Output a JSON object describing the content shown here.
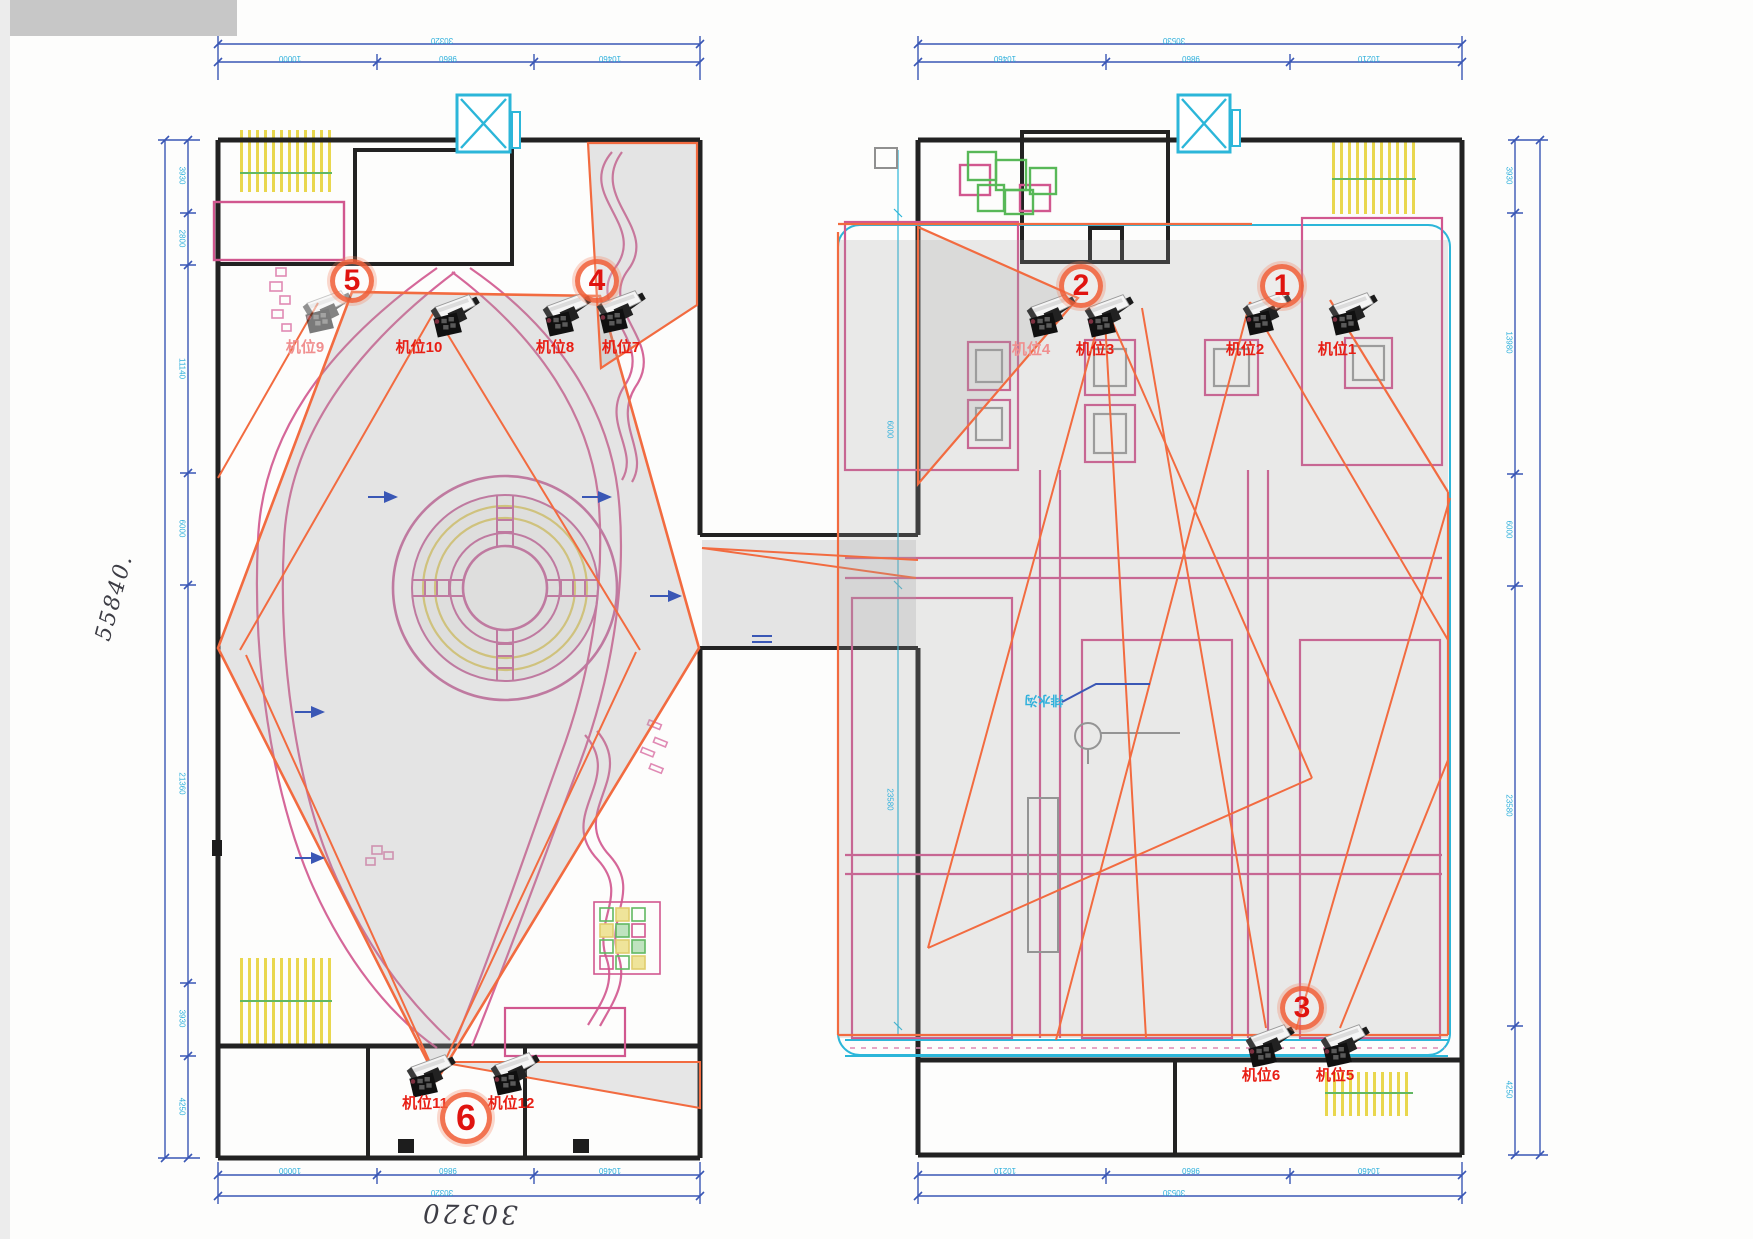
{
  "drawing": {
    "type": "cctv-camera-placement-floor-plan",
    "buildings": [
      "left-garden-block",
      "right-warehouse-block"
    ]
  },
  "colors": {
    "wall": "#1f1f1f",
    "pink": "#d1578f",
    "magenta": "#c44a8c",
    "yellow": "#e6d45a",
    "green": "#62b862",
    "teal": "#2cb6d9",
    "dim_blue": "#3a57b5",
    "dim_cyan": "#2fb0dc",
    "coverage_orange": "#f26b40",
    "marker_red": "#e01410",
    "label_red": "#e81e14"
  },
  "cameras": [
    {
      "id": "cam1",
      "label": "机位1"
    },
    {
      "id": "cam2",
      "label": "机位2"
    },
    {
      "id": "cam3",
      "label": "机位3"
    },
    {
      "id": "cam4",
      "label": "机位4"
    },
    {
      "id": "cam5",
      "label": "机位5"
    },
    {
      "id": "cam6",
      "label": "机位6"
    },
    {
      "id": "cam7",
      "label": "机位7"
    },
    {
      "id": "cam8",
      "label": "机位8"
    },
    {
      "id": "cam9",
      "label": "机位9"
    },
    {
      "id": "cam10",
      "label": "机位10"
    },
    {
      "id": "cam11",
      "label": "机位11"
    },
    {
      "id": "cam12",
      "label": "机位12"
    }
  ],
  "markers": [
    {
      "id": "pos1",
      "number": "1"
    },
    {
      "id": "pos2",
      "number": "2"
    },
    {
      "id": "pos3",
      "number": "3"
    },
    {
      "id": "pos4",
      "number": "4"
    },
    {
      "id": "pos5",
      "number": "5"
    },
    {
      "id": "pos6",
      "number": "6"
    }
  ],
  "handwriting": {
    "left_total": "55840.",
    "bottom_total": "30320"
  },
  "dimensions": {
    "top_left": {
      "total": "30320",
      "segments": [
        "10000",
        "9860",
        "10460"
      ]
    },
    "top_right": {
      "total": "30530",
      "segments": [
        "10460",
        "9860",
        "10210"
      ]
    },
    "bottom_left": {
      "total": "30320",
      "segments": [
        "10000",
        "9860",
        "10460"
      ]
    },
    "bottom_right": {
      "total": "30530",
      "segments": [
        "10210",
        "9860",
        "10460"
      ]
    },
    "left_side": {
      "segments": [
        "3930",
        "2800",
        "11140",
        "6000",
        "21360",
        "3930",
        "4250"
      ]
    },
    "right_side": {
      "segments": [
        "3930",
        "13980",
        "6000",
        "23580",
        "4250"
      ]
    },
    "inner_right": {
      "segments": [
        "6000",
        "23580"
      ]
    }
  },
  "notes": {
    "drain_note": "排水沟"
  }
}
